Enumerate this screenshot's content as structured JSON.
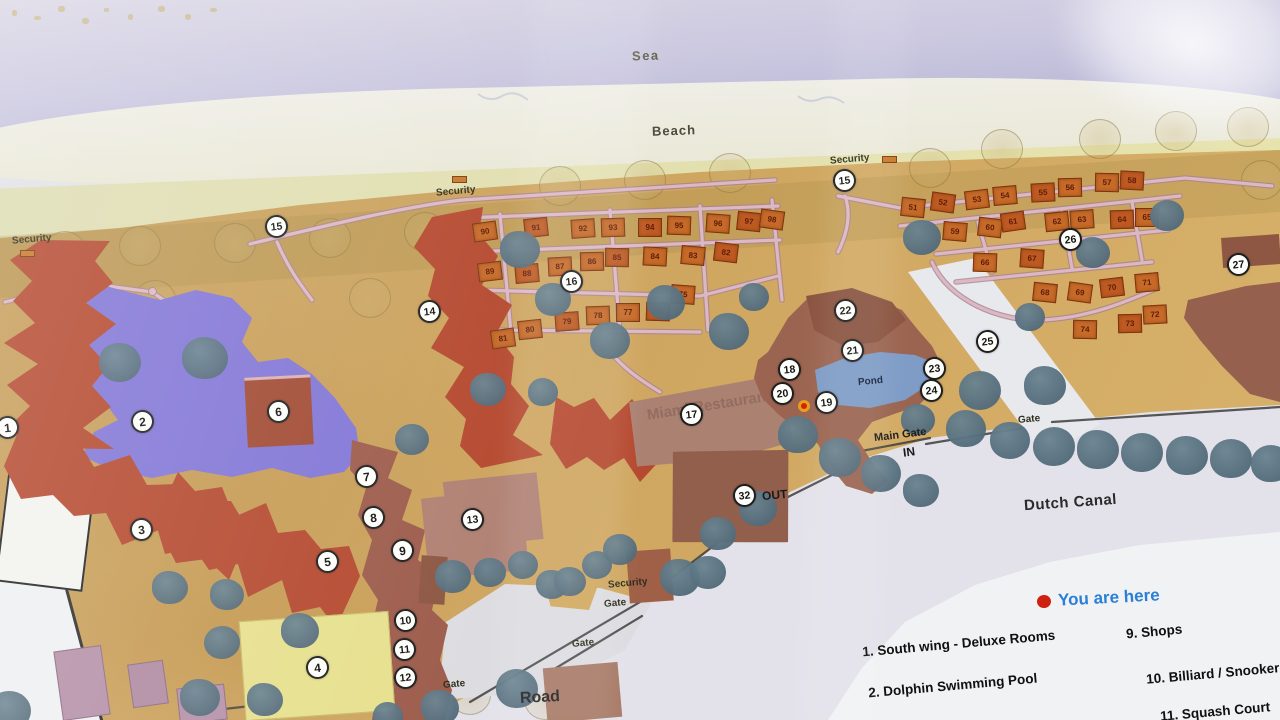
{
  "photo": {
    "width": 1280,
    "height": 720,
    "description": "Resort site map poster photographed through glass"
  },
  "map": {
    "sea_label": "Sea",
    "beach_label": "Beach",
    "road_label": "Road",
    "canal_label": "Dutch Canal",
    "pond_label": "Pond",
    "main_gate_label": "Main Gate",
    "in_label": "IN",
    "out_label": "OUT",
    "security_label": "Security",
    "gate_label": "Gate",
    "restaurant_watermark": "Miami Restaurant",
    "security_posts": [
      {
        "x": 12,
        "y": 234,
        "ix": 20,
        "iy": 250
      },
      {
        "x": 436,
        "y": 186,
        "ix": 452,
        "iy": 176
      },
      {
        "x": 830,
        "y": 154,
        "ix": 882,
        "iy": 156
      },
      {
        "x": 608,
        "y": 578,
        "ix": -1,
        "iy": -1
      }
    ],
    "gates": [
      {
        "x": 1018,
        "y": 414
      },
      {
        "x": 604,
        "y": 598
      },
      {
        "x": 572,
        "y": 638
      },
      {
        "x": 443,
        "y": 679
      }
    ],
    "markers": [
      {
        "n": "1",
        "x": 8,
        "y": 428
      },
      {
        "n": "2",
        "x": 143,
        "y": 422
      },
      {
        "n": "3",
        "x": 142,
        "y": 530
      },
      {
        "n": "4",
        "x": 318,
        "y": 668
      },
      {
        "n": "5",
        "x": 328,
        "y": 562
      },
      {
        "n": "6",
        "x": 279,
        "y": 412
      },
      {
        "n": "7",
        "x": 367,
        "y": 477
      },
      {
        "n": "8",
        "x": 374,
        "y": 518
      },
      {
        "n": "9",
        "x": 403,
        "y": 551
      },
      {
        "n": "10",
        "x": 406,
        "y": 621
      },
      {
        "n": "11",
        "x": 405,
        "y": 650
      },
      {
        "n": "12",
        "x": 406,
        "y": 678
      },
      {
        "n": "13",
        "x": 473,
        "y": 520
      },
      {
        "n": "14",
        "x": 430,
        "y": 312
      },
      {
        "n": "15",
        "x": 277,
        "y": 227
      },
      {
        "n": "15",
        "x": 845,
        "y": 181
      },
      {
        "n": "16",
        "x": 572,
        "y": 282
      },
      {
        "n": "17",
        "x": 692,
        "y": 415
      },
      {
        "n": "18",
        "x": 790,
        "y": 370
      },
      {
        "n": "19",
        "x": 827,
        "y": 403
      },
      {
        "n": "20",
        "x": 783,
        "y": 394
      },
      {
        "n": "21",
        "x": 853,
        "y": 351
      },
      {
        "n": "22",
        "x": 846,
        "y": 311
      },
      {
        "n": "23",
        "x": 935,
        "y": 369
      },
      {
        "n": "24",
        "x": 932,
        "y": 391
      },
      {
        "n": "25",
        "x": 988,
        "y": 342
      },
      {
        "n": "26",
        "x": 1071,
        "y": 240
      },
      {
        "n": "27",
        "x": 1239,
        "y": 265
      },
      {
        "n": "32",
        "x": 745,
        "y": 496
      }
    ],
    "you_are_here_dot": {
      "x": 805,
      "y": 407
    },
    "cottages": {
      "left": [
        [
          485,
          232,
          "90"
        ],
        [
          536,
          228,
          "91"
        ],
        [
          583,
          229,
          "92"
        ],
        [
          613,
          228,
          "93"
        ],
        [
          650,
          228,
          "94"
        ],
        [
          679,
          226,
          "95"
        ],
        [
          718,
          224,
          "96"
        ],
        [
          749,
          222,
          "97"
        ],
        [
          772,
          220,
          "98"
        ],
        [
          490,
          272,
          "89"
        ],
        [
          527,
          274,
          "88"
        ],
        [
          560,
          267,
          "87"
        ],
        [
          592,
          262,
          "86"
        ],
        [
          617,
          258,
          "85"
        ],
        [
          655,
          257,
          "84"
        ],
        [
          693,
          256,
          "83"
        ],
        [
          726,
          253,
          "82"
        ],
        [
          503,
          339,
          "81"
        ],
        [
          530,
          330,
          "80"
        ],
        [
          567,
          322,
          "79"
        ],
        [
          598,
          316,
          "78"
        ],
        [
          628,
          313,
          "77"
        ],
        [
          658,
          312,
          "76"
        ],
        [
          683,
          295,
          "75"
        ]
      ],
      "right": [
        [
          913,
          208,
          "51"
        ],
        [
          943,
          203,
          "52"
        ],
        [
          977,
          200,
          "53"
        ],
        [
          1005,
          196,
          "54"
        ],
        [
          1043,
          193,
          "55"
        ],
        [
          1070,
          188,
          "56"
        ],
        [
          1107,
          183,
          "57"
        ],
        [
          1132,
          181,
          "58"
        ],
        [
          955,
          232,
          "59"
        ],
        [
          990,
          228,
          "60"
        ],
        [
          1013,
          222,
          "61"
        ],
        [
          1057,
          222,
          "62"
        ],
        [
          1082,
          220,
          "63"
        ],
        [
          1122,
          220,
          "64"
        ],
        [
          1147,
          218,
          "65"
        ],
        [
          985,
          263,
          "66"
        ],
        [
          1032,
          259,
          "67"
        ],
        [
          1045,
          293,
          "68"
        ],
        [
          1080,
          293,
          "69"
        ],
        [
          1112,
          288,
          "70"
        ],
        [
          1147,
          283,
          "71"
        ],
        [
          1155,
          315,
          "72"
        ],
        [
          1130,
          324,
          "73"
        ],
        [
          1085,
          330,
          "74"
        ]
      ]
    },
    "trees": [
      [
        520,
        249,
        40
      ],
      [
        553,
        300,
        36
      ],
      [
        610,
        340,
        40
      ],
      [
        666,
        302,
        38
      ],
      [
        729,
        331,
        40
      ],
      [
        754,
        297,
        30
      ],
      [
        488,
        390,
        36
      ],
      [
        543,
        392,
        30
      ],
      [
        412,
        440,
        34
      ],
      [
        120,
        362,
        42
      ],
      [
        205,
        358,
        46
      ],
      [
        922,
        237,
        38
      ],
      [
        1093,
        253,
        34
      ],
      [
        1167,
        216,
        34
      ],
      [
        1030,
        317,
        30
      ],
      [
        980,
        390,
        42
      ],
      [
        1045,
        385,
        42
      ],
      [
        918,
        420,
        34
      ],
      [
        966,
        428,
        40
      ],
      [
        1010,
        440,
        40
      ],
      [
        1054,
        446,
        42
      ],
      [
        1098,
        449,
        42
      ],
      [
        1142,
        452,
        42
      ],
      [
        1187,
        455,
        42
      ],
      [
        1231,
        458,
        42
      ],
      [
        1271,
        463,
        40
      ],
      [
        798,
        434,
        40
      ],
      [
        840,
        457,
        42
      ],
      [
        881,
        473,
        40
      ],
      [
        921,
        491,
        36
      ],
      [
        758,
        508,
        38
      ],
      [
        718,
        534,
        36
      ],
      [
        453,
        577,
        36
      ],
      [
        490,
        573,
        32
      ],
      [
        523,
        565,
        30
      ],
      [
        552,
        585,
        32
      ],
      [
        597,
        565,
        30
      ],
      [
        680,
        577,
        40
      ],
      [
        708,
        573,
        36
      ],
      [
        517,
        688,
        42
      ],
      [
        440,
        707,
        38
      ],
      [
        388,
        716,
        30
      ],
      [
        620,
        550,
        34
      ],
      [
        570,
        582,
        32
      ],
      [
        170,
        588,
        36
      ],
      [
        227,
        595,
        34
      ],
      [
        222,
        643,
        36
      ],
      [
        300,
        630,
        38
      ],
      [
        200,
        697,
        40
      ],
      [
        265,
        700,
        36
      ],
      [
        10,
        710,
        42
      ]
    ],
    "faded_trees": [
      [
        65,
        251
      ],
      [
        140,
        246
      ],
      [
        235,
        243
      ],
      [
        330,
        238
      ],
      [
        425,
        232
      ],
      [
        560,
        186
      ],
      [
        645,
        180
      ],
      [
        730,
        173
      ],
      [
        930,
        168
      ],
      [
        1002,
        149
      ],
      [
        1100,
        139
      ],
      [
        1176,
        131
      ],
      [
        1248,
        127
      ],
      [
        1262,
        180
      ],
      [
        155,
        300
      ],
      [
        370,
        298
      ],
      [
        470,
        695
      ],
      [
        545,
        700
      ],
      [
        265,
        688
      ]
    ]
  },
  "legend": {
    "you_are_here": "You are here",
    "items": [
      {
        "n": "1",
        "text": "South wing - Deluxe Rooms"
      },
      {
        "n": "2",
        "text": "Dolphin Swimming Pool"
      },
      {
        "n": "9",
        "text": "Shops"
      },
      {
        "n": "10",
        "text": "Billiard / Snooker"
      },
      {
        "n": "11",
        "text": "Squash Court"
      }
    ]
  },
  "colors": {
    "sea": "#c3c0da",
    "beach": "#dfdcb2",
    "ground": "#cda45e",
    "building_red": "#b5492f",
    "pool_purple": "#8276d6",
    "cottage_orange": "#c56a28",
    "building_brown": "#9a6450",
    "pond_blue": "#7e9cc6",
    "tree_gray": "#597180",
    "path_pink": "#dcb8c4",
    "you_are_here_blue": "#2a7fd6",
    "marker_red": "#d42300",
    "yellow_building": "#e7e08e"
  }
}
